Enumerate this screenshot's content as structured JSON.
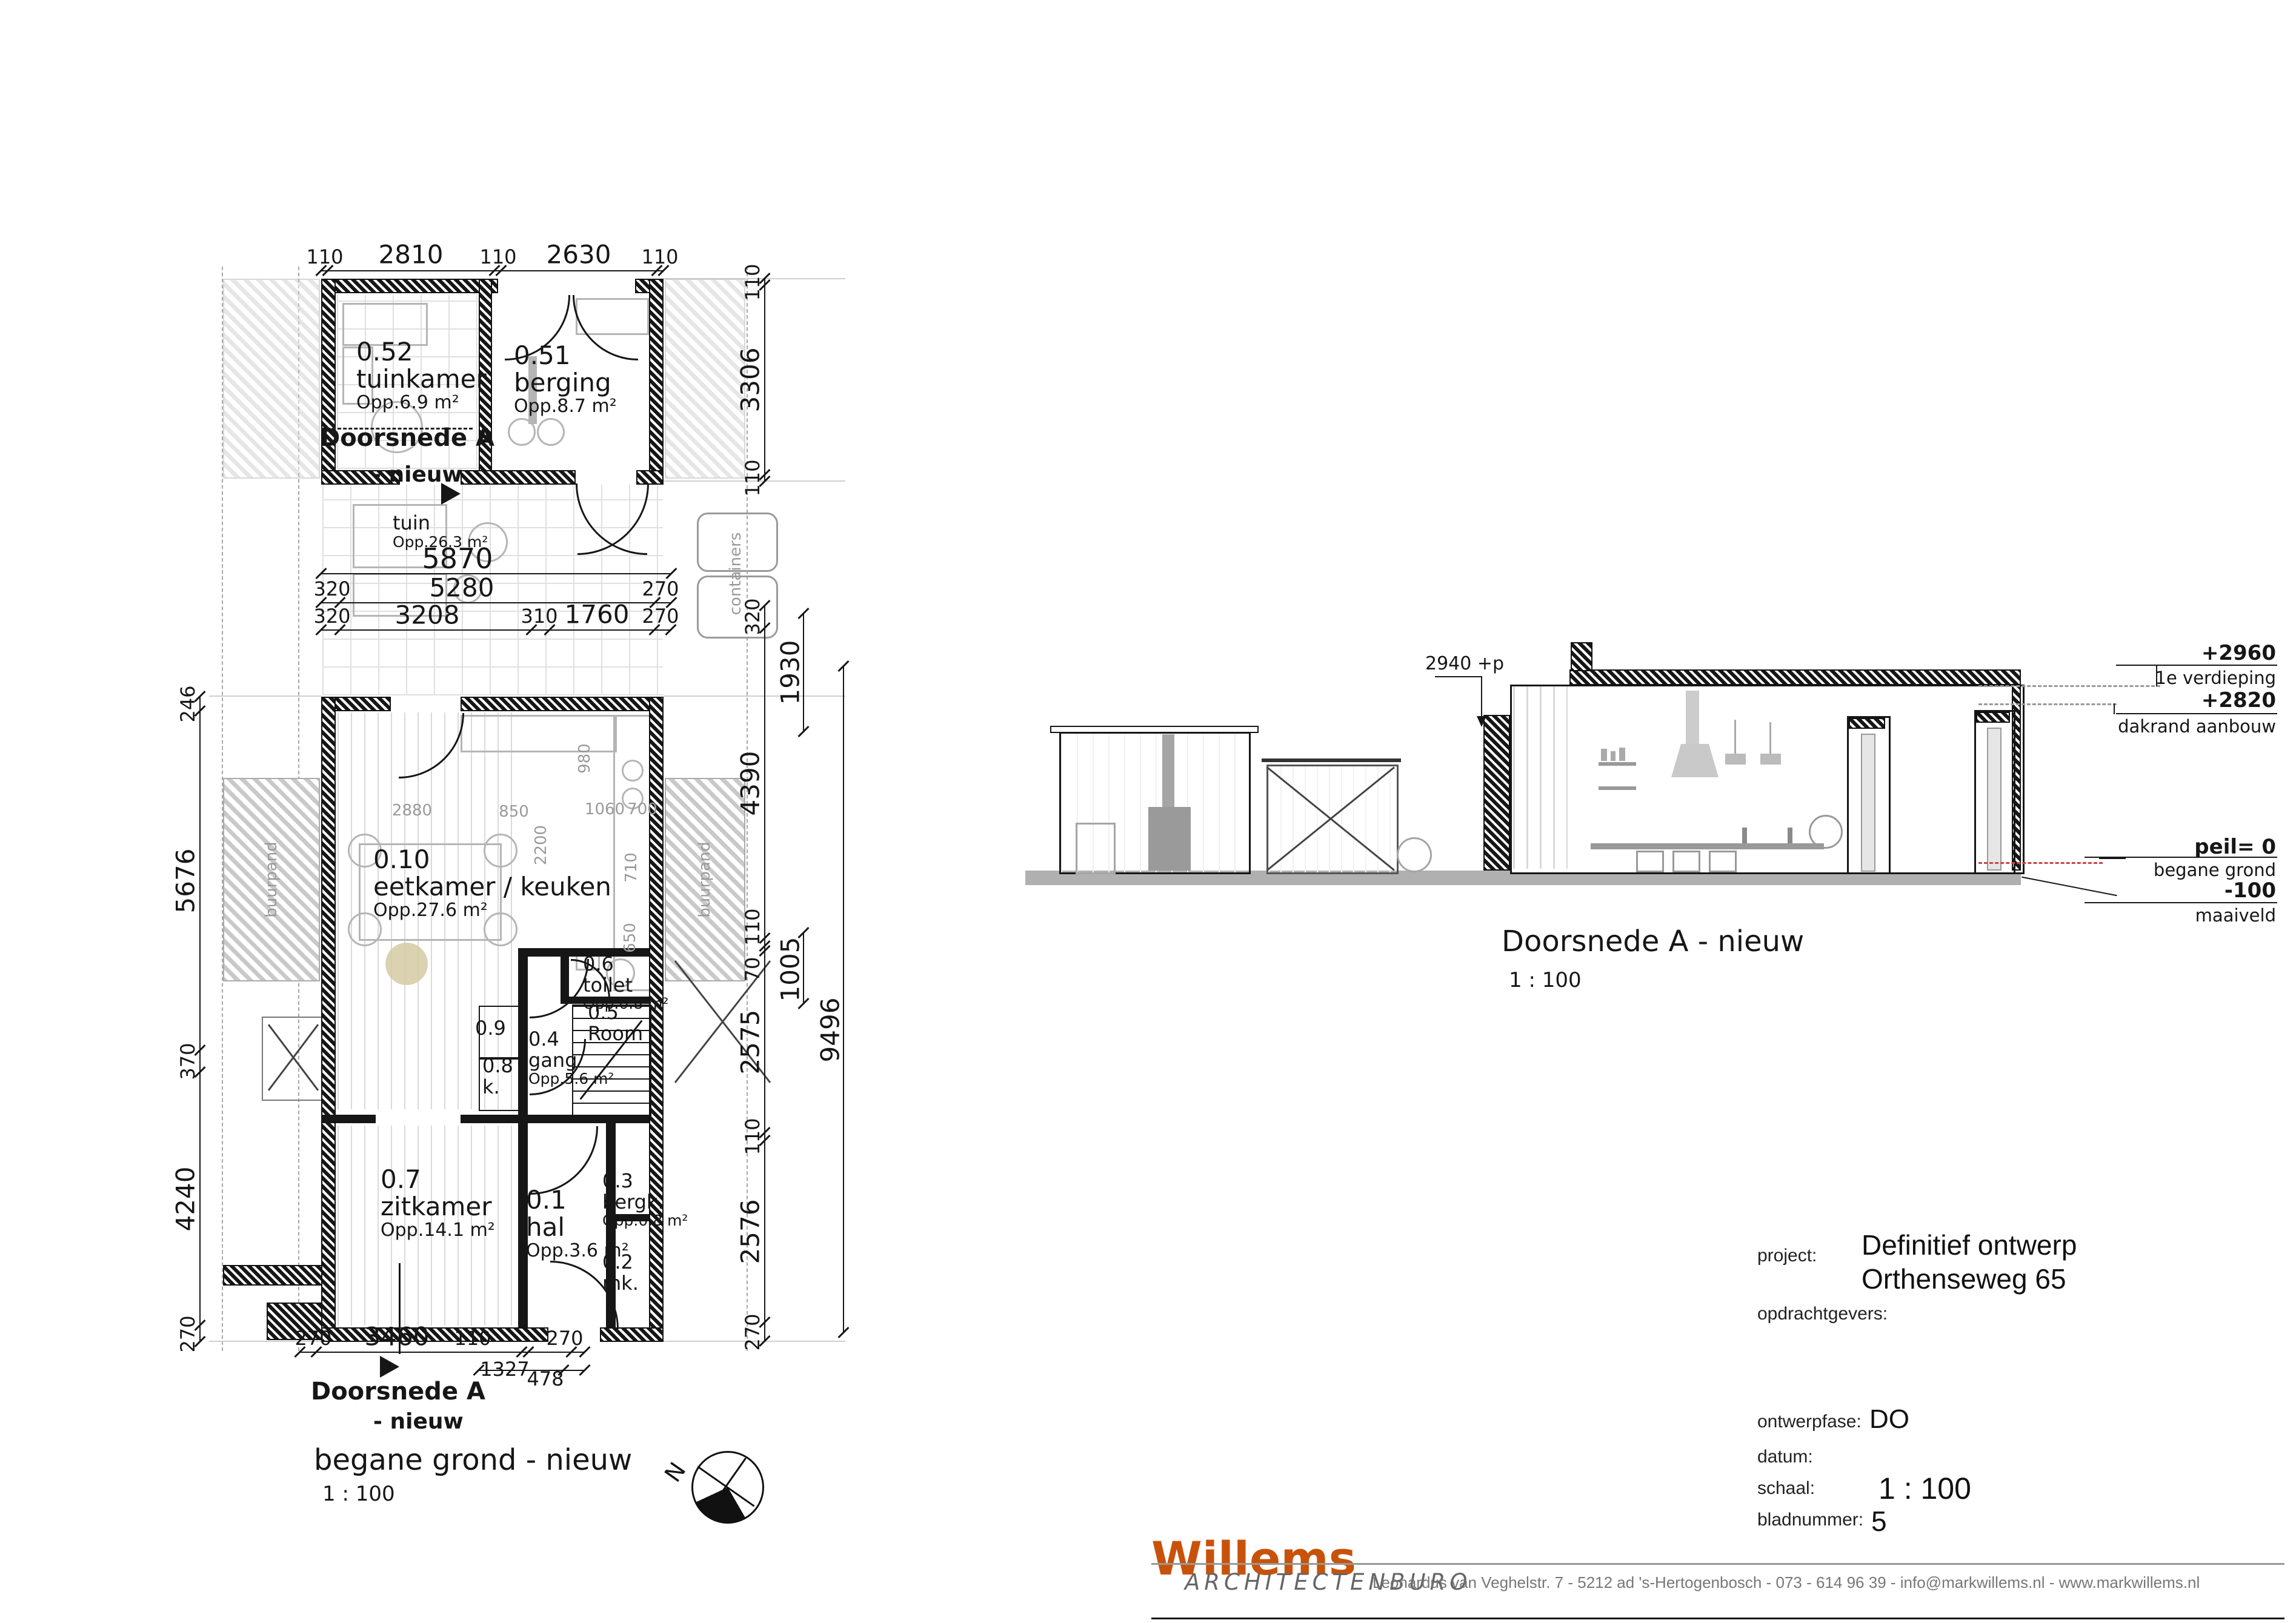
{
  "plan": {
    "title": "begane grond - nieuw",
    "scale": "1 : 100",
    "north": "N",
    "section_marker": {
      "line1": "Doorsnede A",
      "line2": "- nieuw"
    },
    "rooms": {
      "tuinkamer": {
        "id": "0.52",
        "name": "tuinkamer",
        "area": "Opp.6.9 m²"
      },
      "berging051": {
        "id": "0.51",
        "name": "berging",
        "area": "Opp.8.7 m²"
      },
      "tuin": {
        "name": "tuin",
        "area": "Opp.26.3 m²"
      },
      "eetkamer": {
        "id": "0.10",
        "name": "eetkamer / keuken",
        "area": "Opp.27.6 m²"
      },
      "toilet": {
        "id": "0.6",
        "name": "toilet",
        "area": "Opp.0.8 m²"
      },
      "trap": {
        "id": "0.5",
        "name": "Room"
      },
      "gang": {
        "id": "0.4",
        "name": "gang",
        "area": "Opp.5.6 m²"
      },
      "kast9": {
        "id": "0.9"
      },
      "kast8": {
        "id": "0.8",
        "name": "k."
      },
      "zitkamer": {
        "id": "0.7",
        "name": "zitkamer",
        "area": "Opp.14.1 m²"
      },
      "hal": {
        "id": "0.1",
        "name": "hal",
        "area": "Opp.3.6 m²"
      },
      "bergkast": {
        "id": "0.3",
        "name": "bergk.",
        "area": "Opp.0.8 m²"
      },
      "meterkast": {
        "id": "0.2",
        "name": "mk."
      }
    },
    "annotations": {
      "buurpand_left": "buurpand",
      "buurpand_right": "buurpand",
      "containers": "containers"
    },
    "dims": {
      "top": [
        "110",
        "2810",
        "110",
        "2630",
        "110"
      ],
      "left": [
        "246",
        "5676",
        "370",
        "4240",
        "270"
      ],
      "right_inner_top": [
        "110",
        "3306",
        "110"
      ],
      "right_inner": [
        "320",
        "4390",
        "110",
        "70",
        "2575",
        "110",
        "2576",
        "270"
      ],
      "right_outer": [
        "1930",
        "1005",
        "9496"
      ],
      "mid1": [
        "5870"
      ],
      "mid2": [
        "320",
        "5280",
        "270"
      ],
      "mid3": [
        "320",
        "3208",
        "310",
        "1760",
        "270"
      ],
      "bottom": [
        "270",
        "3460",
        "110",
        "270"
      ],
      "bottom2": [
        "1327",
        "478"
      ],
      "kitchen": [
        "2880",
        "850",
        "1060",
        "700",
        "2200",
        "710",
        "650",
        "980"
      ]
    }
  },
  "section": {
    "title": "Doorsnede A  - nieuw",
    "scale": "1 : 100",
    "note": "2940 +p",
    "levels": {
      "l1": {
        "value": "+2960",
        "label": "1e verdieping"
      },
      "l2": {
        "value": "+2820",
        "label": "dakrand aanbouw"
      },
      "l3": {
        "value": "peil= 0",
        "label": "begane grond"
      },
      "l4": {
        "value": "-100",
        "label": "maaiveld"
      }
    }
  },
  "titleblock": {
    "project_label": "project:",
    "project_line1": "Definitief ontwerp",
    "project_line2": "Orthenseweg 65",
    "clients_label": "opdrachtgevers:",
    "phase_label": "ontwerpfase:",
    "phase_value": "DO",
    "date_label": "datum:",
    "scale_label": "schaal:",
    "scale_value": "1 : 100",
    "sheet_label": "bladnummer:",
    "sheet_value": "5"
  },
  "footer": {
    "brand": "Willems",
    "studio": "ARCHITECTENBURO",
    "address": "Leonardus van Veghelstr. 7  -  5212 ad 's-Hertogenbosch  -  073  -  614 96 39  -  info@markwillems.nl  -  www.markwillems.nl"
  },
  "colors": {
    "accent": "#c9520a",
    "muted": "#808080",
    "level_red": "#cc4444"
  }
}
